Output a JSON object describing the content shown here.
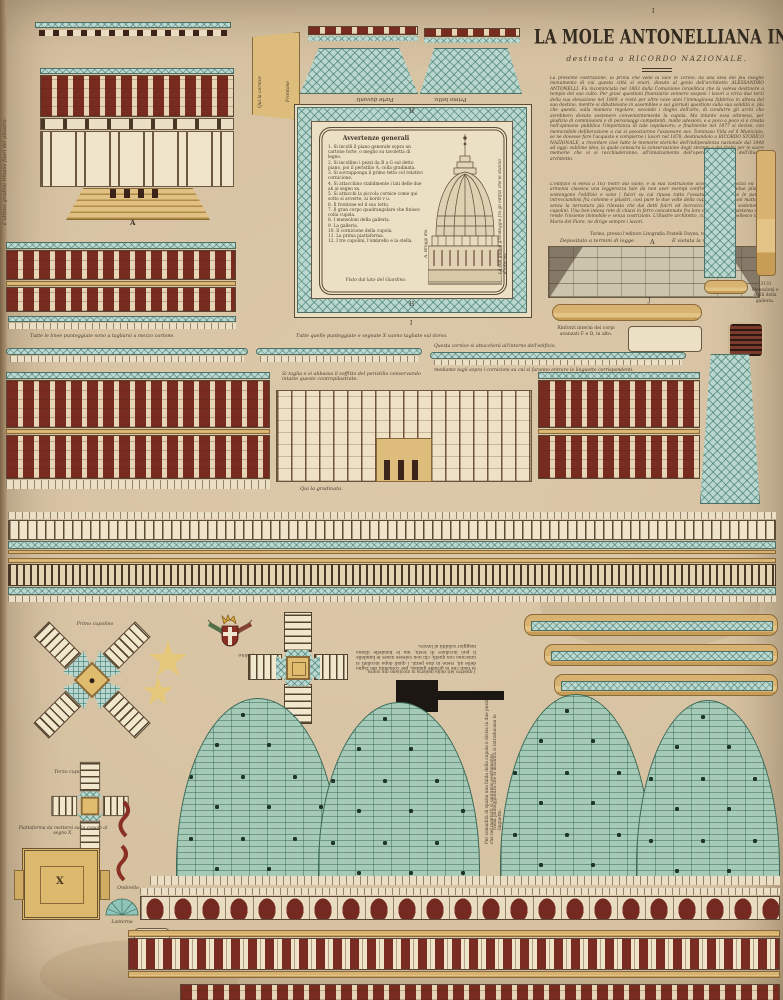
{
  "labels": {
    "a": "A",
    "j": "J",
    "x": "X",
    "h": "H",
    "i": "I",
    "primo_cupolino": "Primo cupolino",
    "secondo_cupolino": "Secondo cupolino",
    "terzo_cupolino": "Terzo cupolino",
    "piattaforma": "Piattaforma da mettersi sulla cupola al segno X.",
    "ombrello": "Ombrello",
    "lanterna": "Lanterna",
    "mensoloni_num": "3131",
    "mensoloni": "Mensoloni e stalli della galleria."
  },
  "title_block": {
    "title": "LA MOLE ANTONELLIANA IN TORINO",
    "subtitle": "destinata a RICORDO NAZIONALE.",
    "para1": "La presente costruzione, la prima che vede la luce in Torino, dà una idea del più insigne monumento di cui questa città si onori, dovuto al genio dell'architetto ALESSANDRO ANTONELLI. Fu incominciata nel 1863 dalla Comunione Israelitica che la voleva destinare a tempio del suo culto. Per gravi questioni finanziarie vennero sospesi i lavori a circa due terzi della sua elevazione nel 1869, e restò per oltre nove anni l'immaginosa fabbrica in attesa del suo destino, mentre si dibattevano in assemblee e sui giornali questioni sulla sua solidità e, più che questa, sulla maniera regolare, secondo i dogmi dell'arte, di condurre gli archi che avrebbero dovuto sostenere convenientemente la cupola. Ma intanto essa otteneva, per giudizio di commissioni e di personaggi competenti, molte adesioni, e a poco a poco si è creata nell'opinione pubblica l'importanza di tale capolavoro; e finalmente nel 1877 si decise, con memorabile deliberazione a cui si associarono l'assessore avv. Tommaso Villa ed il Municipio, se ne dovesse fare l'acquisto e compierne i lavori nel 1878, destinandolo a RICORDO STORICO NAZIONALE, a ricordare cioè tutte le memorie storiche dell'indipendenza nazionale dal 1848 ad oggi: sublime idea, la quale consacra la conservazione degli stemmi e dei trofei per le sacre memorie che vi si racchiuderanno, all'innalzamento dell'opera importante dell'illustre architetto.",
    "para2": "L'edifizio si eleva a 163 metri dal suolo, e la sua costruzione accoppia alla bellezza ed alla armonia classica una leggerezza tale da non aver esempi confrontabili. Trentadue pilastri sostengono l'edifizio e sono i fulcri su cui riposa tutta l'ossatura; come tutte le pareti, intrecciandosi fra colonne e pilastri, così pure le due volte della cupola sono d'un sol mattone, senza la nervatura più rilevata che dai detti fulcri ed incrocicchiati vanno a sostenere i cupolini. Una ben intesa rete di chiavi in ferro concatenate fra loro compie tutto il sistema e ne rende l'insieme immobile e senza costrizioni. L'illustre architetto, come già il Brunellesco in S. Maria del Fiore, ne dirige sempre i lavori.",
    "signature": "G. B.",
    "editor_line": "Torino, presso l'editore Litografia Fratelli Doyen, via Po, 15.",
    "deposit_left": "Depositato a termini di legge",
    "deposit_right": "È vietata la riproduzione."
  },
  "avvertenze": {
    "title": "Avvertenze generali",
    "items": [
      "1. Si incolli il piano generale sopra un cartone forte, o meglio su tavoletta di legno.",
      "2. Si incollino i pezzi da B a G sul detto piano, poi il peristilio A, colla gradinata.",
      "3. Si sovrapponga il primo tetto col relativo cornicione.",
      "4. Si attacchino stabilmente i lati delle due ali al segno xx.",
      "5. Si attacchi la piccola cornice come qui sotto si avverte, ai bordi v u.",
      "6. Il frontone ed il suo tetto.",
      "7. Il gran corpo quadrangolare che finisce colla cupola.",
      "8. I mensoloni della galleria.",
      "9. La galleria.",
      "10. Il cornicione della cupola.",
      "11. La prima piattaforma.",
      "12. I tre cupolini, l'ombrello e la stella."
    ],
    "footer": "Visto dal lato del Giardino.",
    "side_left": "A. Broggi dis.",
    "side_right": "La sua guglia grandeggia fra gli edifizi che le stanno d'intorno."
  },
  "captions": {
    "cut1": "Tutte le linee punteggiate sono a tagliarsi a mezzo cartone.",
    "cut2": "Tutte quelle punteggiate e segnate X vanno tagliate sul dorso.",
    "soffitto": "Si taglia e si abbassa il soffitto del peristilio conservando intatte queste contropilastrate.",
    "cornice1": "Questa cornice si attaccherà all'intorno dell'edificio,",
    "cornice2": "mediante tagli sopra i cornicioni su cui si faranno entrare le linguette corrispondenti.",
    "rinforzi": "Rinforzi interni dei corpi avanzati F e D, in alto.",
    "gradinata": "Qui la gradinata.",
    "gradino": "L'ultimo gradino rimane fuori del pilastro.",
    "qui_cornice": "Qui la cornice",
    "frontone": "Frontone",
    "primo_tetto": "Primo tetto.",
    "parte_davanti": "Parte davanti",
    "quattro_lati": "I quattro lati della galleria si incollano qui sopra.",
    "assembly": "Si badi che la grande gabbia, per comodità del taglio delle ali, viene in due pezzi, i quali dopo incollati si uniscono con quelli; chi non volesse usare le bandelle li può incollare di testa, ma le bandelle dànno maggior solidità al lavoro.",
    "falda": "Per comodità di spazio una falda della cupola è divisa in due pezzi che nel montarli si uniranno esattamente.",
    "punteggiatura": "Nella punteggiatura che si incontra si introducano le linguette."
  }
}
